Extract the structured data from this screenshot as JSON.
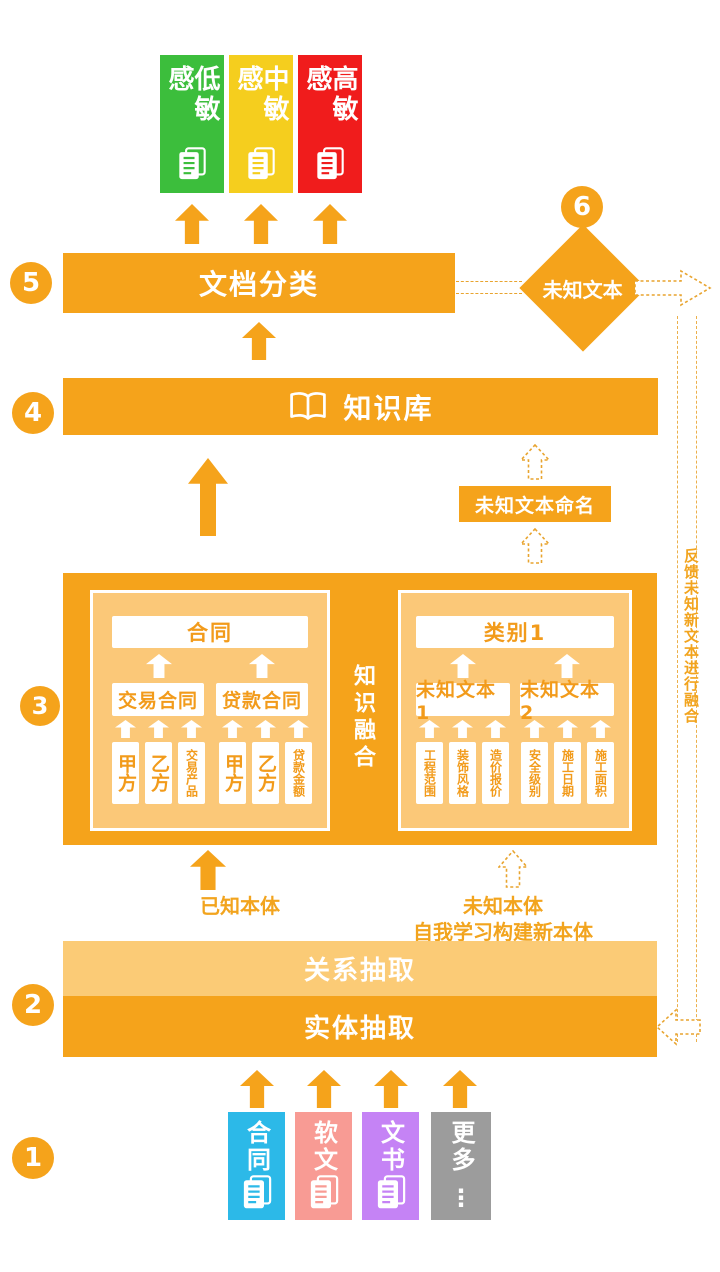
{
  "colors": {
    "orange": "#F5A31B",
    "orange_light": "#FBCB76",
    "panel_bg": "#FBC878",
    "green": "#3CBE3C",
    "gold": "#F5CE1E",
    "red": "#F01C1C",
    "blue": "#2CB9E8",
    "pink": "#F89B94",
    "purple": "#C583F5",
    "gray": "#9C9C9C"
  },
  "step_numbers": [
    "1",
    "2",
    "3",
    "4",
    "5",
    "6"
  ],
  "sensitivity_levels": [
    {
      "label": "低敏感",
      "color": "#3CBE3C"
    },
    {
      "label": "中敏感",
      "color": "#F5CE1E"
    },
    {
      "label": "高敏感",
      "color": "#F01C1C"
    }
  ],
  "doc_classification_bar": {
    "label": "文档分类"
  },
  "unknown_text_diamond": {
    "label": "未知文本"
  },
  "knowledge_base_bar": {
    "label": "知识库"
  },
  "unknown_text_naming_box": {
    "label": "未知文本命名"
  },
  "knowledge_fusion_label": "知识融合",
  "known_ontology_panel": {
    "root": "合同",
    "children": [
      "交易合同",
      "贷款合同"
    ],
    "attributes": [
      "甲方",
      "乙方",
      "交易产品",
      "甲方",
      "乙方",
      "贷款金额"
    ]
  },
  "unknown_ontology_panel": {
    "root": "类别1",
    "children": [
      "未知文本1",
      "未知文本2"
    ],
    "attributes": [
      "工程范围",
      "装饰风格",
      "造价报价",
      "安全级别",
      "施工日期",
      "施工面积"
    ]
  },
  "ontology_labels": {
    "known": "已知本体",
    "unknown_line1": "未知本体",
    "unknown_line2": "自我学习构建新本体"
  },
  "relation_extraction_bar": {
    "label": "关系抽取"
  },
  "entity_extraction_bar": {
    "label": "实体抽取"
  },
  "feedback_label": "反馈未知新文本进行融合",
  "source_documents": [
    {
      "label": "合同",
      "color": "#2CB9E8"
    },
    {
      "label": "软文",
      "color": "#F89B94"
    },
    {
      "label": "文书",
      "color": "#C583F5"
    },
    {
      "label": "更多",
      "color": "#9C9C9C",
      "more_indicator": "⋮"
    }
  ]
}
